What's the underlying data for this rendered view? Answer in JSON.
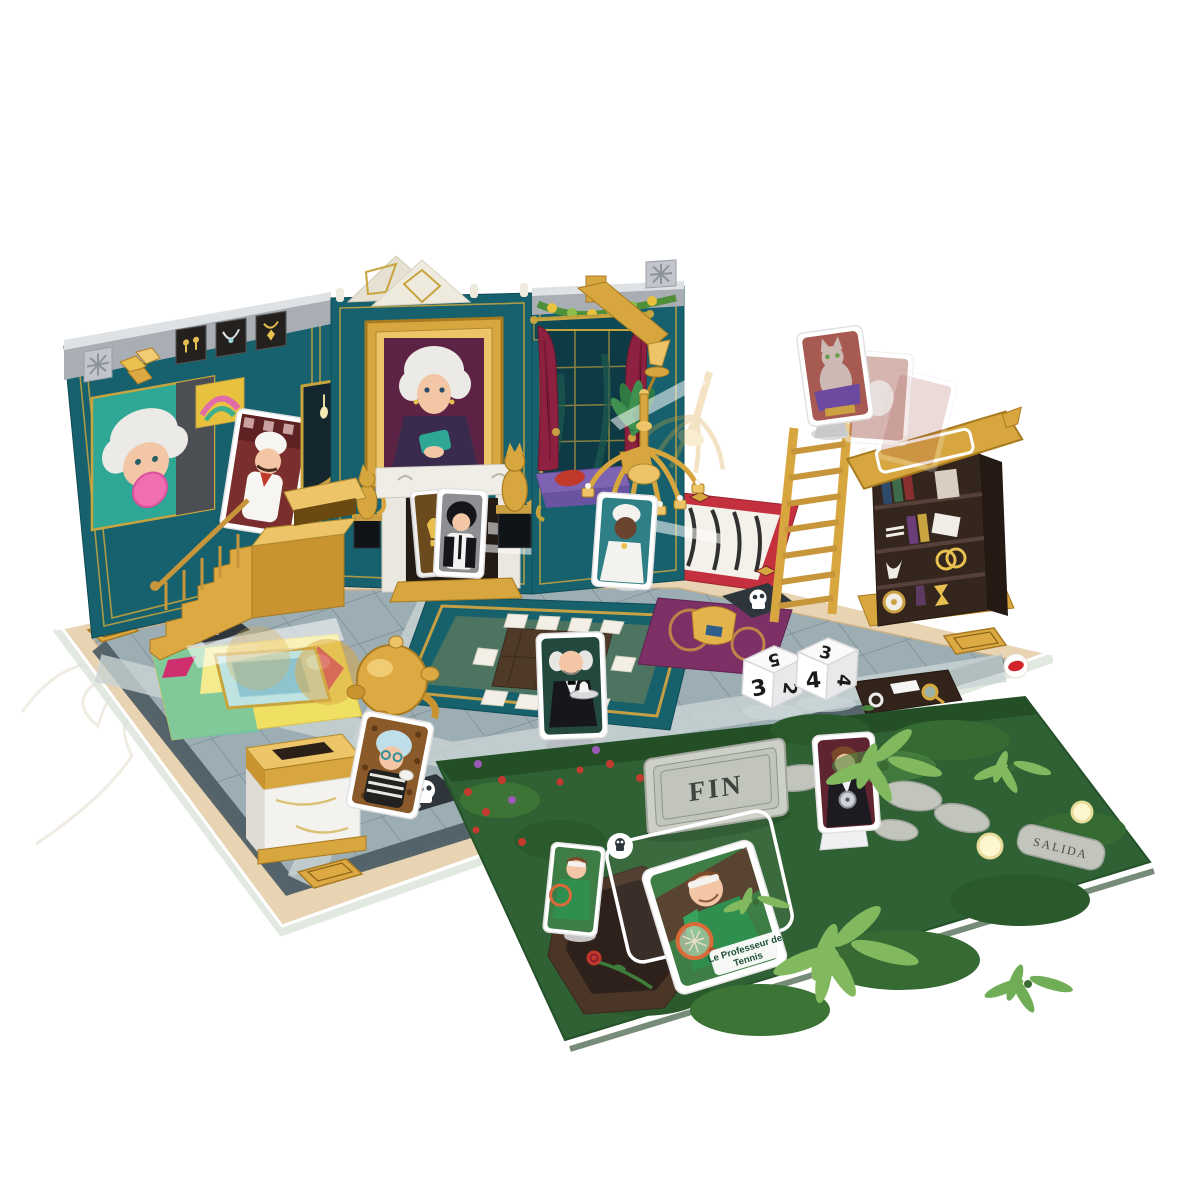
{
  "board": {
    "fin_label": "FIN",
    "salida_label": "SALIDA",
    "tennis_card_label_line1": "Le Professeur de",
    "tennis_card_label_line2": "Tennis"
  },
  "dice": {
    "left": {
      "top": "5",
      "front": "3",
      "side": "2"
    },
    "right": {
      "top": "3",
      "front": "4",
      "side": "4"
    }
  },
  "icons": {
    "skull": "☠"
  },
  "colors": {
    "wall_teal": "#16616d",
    "garden_green": "#2f6134",
    "curtain_red": "#8e2040",
    "logo_red": "#d1232a",
    "gold": "#dda942",
    "floor_grey": "#9cadb3",
    "board_border_tan": "#e8d4b2",
    "zebra_red": "#c5303e"
  }
}
